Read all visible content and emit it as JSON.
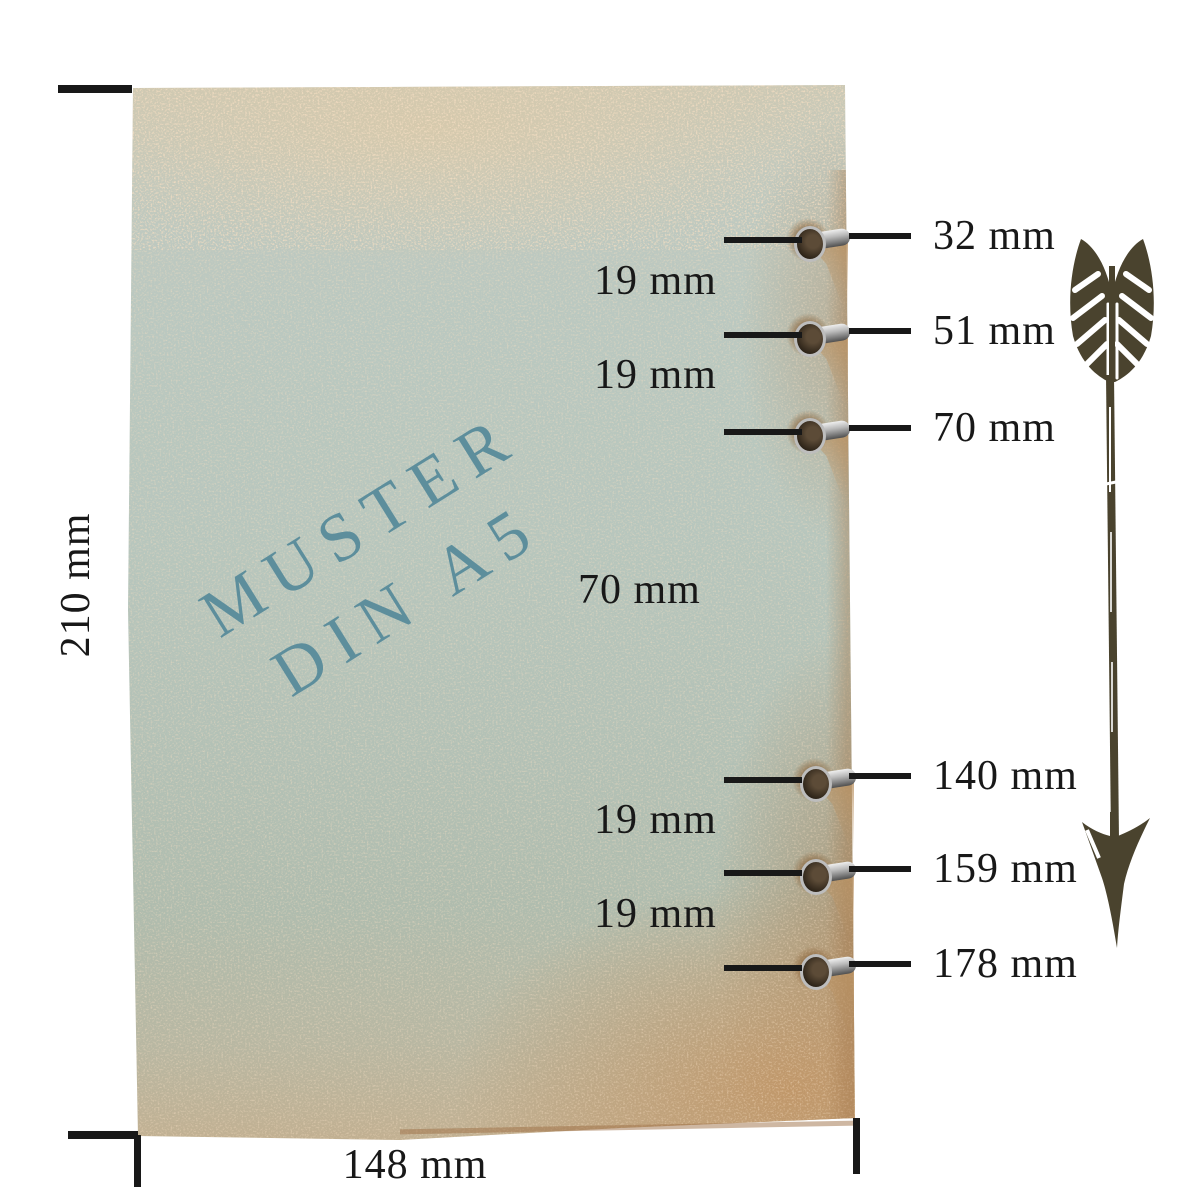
{
  "paper": {
    "watermark": {
      "line1": "MUSTER",
      "line2": "DIN A5"
    }
  },
  "dimension_labels": {
    "height": "210 mm",
    "width": "148 mm"
  },
  "hole_callouts": [
    {
      "label": "32 mm"
    },
    {
      "label": "51 mm"
    },
    {
      "label": "70 mm"
    },
    {
      "label": "140 mm"
    },
    {
      "label": "159 mm"
    },
    {
      "label": "178 mm"
    }
  ],
  "spacing_labels": [
    {
      "label": "19 mm"
    },
    {
      "label": "19 mm"
    },
    {
      "label": "70 mm"
    },
    {
      "label": "19 mm"
    },
    {
      "label": "19 mm"
    }
  ],
  "icons": {
    "arrow": "down-arrow-icon",
    "eyelet": "eyelet-grommet"
  },
  "colors": {
    "page_bg": "#ffffff",
    "ink": "#181818",
    "watermark": "#5d8e9c",
    "arrow": "#4a432e",
    "paper_top": "#d6c9af",
    "paper_mid": "#b7c6bd",
    "paper_bottom": "#c5ad8b",
    "rust": "#a07042",
    "metal": "#b9b9b9"
  }
}
